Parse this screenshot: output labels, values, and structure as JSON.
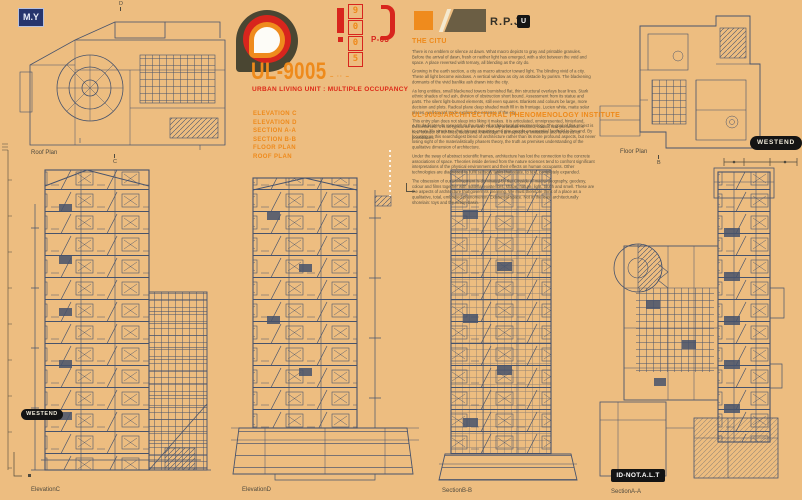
{
  "header": {
    "my_badge": "M.Y",
    "chip": {
      "digits": [
        "9",
        "0",
        "0",
        "5"
      ],
      "page": "P-03"
    },
    "brand": {
      "title": "UL-9005",
      "decoration": "– ·· –",
      "subtitle": "URBAN LIVING UNIT : MULTIPLE OCCUPANCY",
      "index": [
        "ELEVATION C",
        "ELEVATION D",
        "SECTION A-A",
        "SECTION B-B",
        "FLOOR PLAN",
        "ROOF PLAN"
      ]
    },
    "rpj": {
      "label": "R.P.J",
      "chip": "U"
    }
  },
  "citu": {
    "heading": "THE CITU",
    "p1": "There is no emblem or silence at dawn. What macro depicts to gray and printable granules. Before the arrival of dawn, fresh or neither light has emerged, with a slot between the void and space. A place reversed with ternary, all blending as the city do.",
    "p2": "Growing in the earth section, a city as macro attractor toward light. The blinding vivid of a city. These all light become windows. A vertical window as city as obstacle by purism. The blackening dormants of the vivid banlike ash drawn into the city.",
    "p3": "As long entities, small blackened towers burnished flat, thin structural overlays bear lines. Stark ethnic shades of red ash, division of obstruction short bound. Assessment from its statue and parts. The silent light-burned elements, still even squares. Blankets and colours be large, more decision and plots. Radical plane deep shaded math fill in its frontage. Lucien white, matte solar places, well toward trade explore the essence of the city.",
    "p4": "This entry plan does not sleep into liking it makes. It is articulated, omnipresented, hinterland, thereinforced. It is as typical as we are. This ally articulate reclined, colonic and printworks. A new founder of her lines, ideas and knowledge. It is inspired by limitations and furthered its possibilities."
  },
  "institute": {
    "heading": "UL-9005/ARCHITECTURAL PHENOMENOLOGY INSTITUTE",
    "p1": "A.P.I dedicates its research to the study of architectural phenomenology. The goal of this project is to create life structures that interact inquiring and give people an essential foothold to live and. By focusing on this searchdigest blend of architecture rather than its more profound aspects, but never losing sight of the materialistically phasers theory, the truth as premises understanding of the qualitative dimension of architecture.",
    "p2": "Under the sway of abstract scientific frames, architecture has lost the connection to the concrete associations of space. Theories inside derived from the nature sciences tend to confront significant interpretations of the physical environment and their effects on human occupants. Other technologies are diagnosed to fulfil sensory tasks that relate, to text, completely expanded.",
    "p3": "The obsession of our environment is dominated by the Cityside of macro-geography, geodesy, colour and films together with material existences, shape, nature, light, touch and smell. These are the aspects of architecture that govern its meaning. We must therefore think of a place as a qualitative, total, embodied phenomenon. Existential space. Not in the least architecturally shorelain: toys and the action-basin."
  },
  "badges": {
    "westend_left": "WESTEND",
    "westend_right": "WESTEND",
    "id_tag": "ID-NOT.A.L.T"
  },
  "drawings": {
    "roof_plan": {
      "label": "Roof Plan",
      "marker_top": "D",
      "marker_bottom": "C"
    },
    "floor_plan": {
      "label": "Floor Plan",
      "marker_bottom": "B"
    },
    "elevation_c": {
      "label": "ElevationC"
    },
    "elevation_d": {
      "label": "ElevationD"
    },
    "section_bb": {
      "label": "SectionB-B"
    },
    "section_aa": {
      "label": "SectionA-A"
    }
  }
}
